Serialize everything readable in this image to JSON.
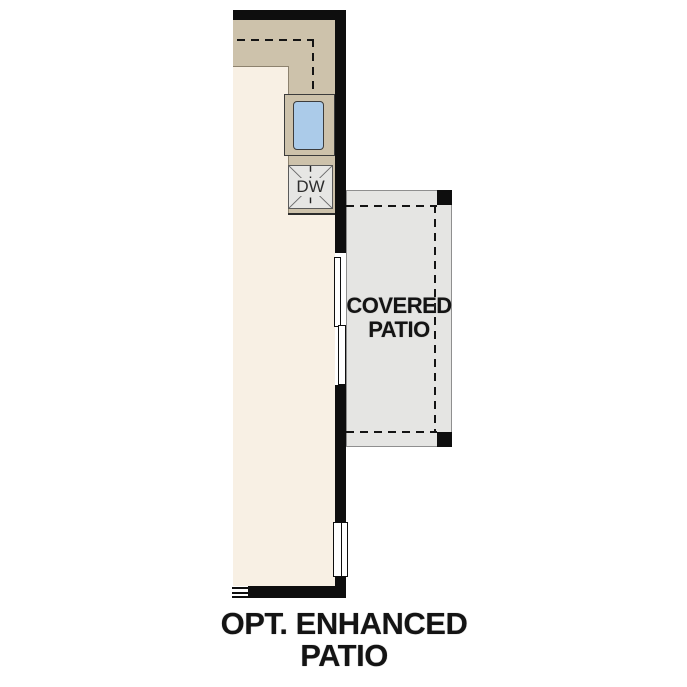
{
  "plan": {
    "labels": {
      "dishwasher": "DW",
      "covered_patio": {
        "line1": "COVERED",
        "line2": "PATIO"
      },
      "caption": {
        "line1": "OPT. ENHANCED",
        "line2": "PATIO"
      }
    },
    "colors": {
      "wall": "#0e0e0e",
      "floor": "#f8f0e4",
      "counter": "#cdc2ab",
      "sink": "#abcbe9",
      "appliance": "#e6e6e4",
      "patio": "#e5e5e3",
      "outline": "#3c3c3c",
      "patio_outline": "#8f8f8f",
      "text": "#141414"
    }
  }
}
